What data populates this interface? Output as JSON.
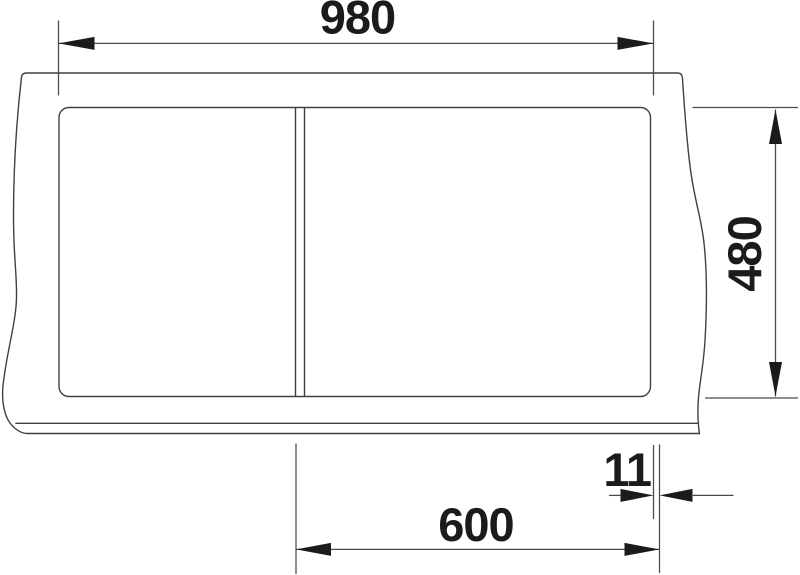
{
  "drawing": {
    "kind": "sink-worktop-installation-dimension-drawing",
    "labels": {
      "width_overall": "980",
      "depth_overall": "480",
      "bowl_zone_width": "600",
      "edge_gap": "11"
    },
    "colors": {
      "background": "#ffffff",
      "line": "#404040",
      "text": "#1b1b1b"
    }
  }
}
